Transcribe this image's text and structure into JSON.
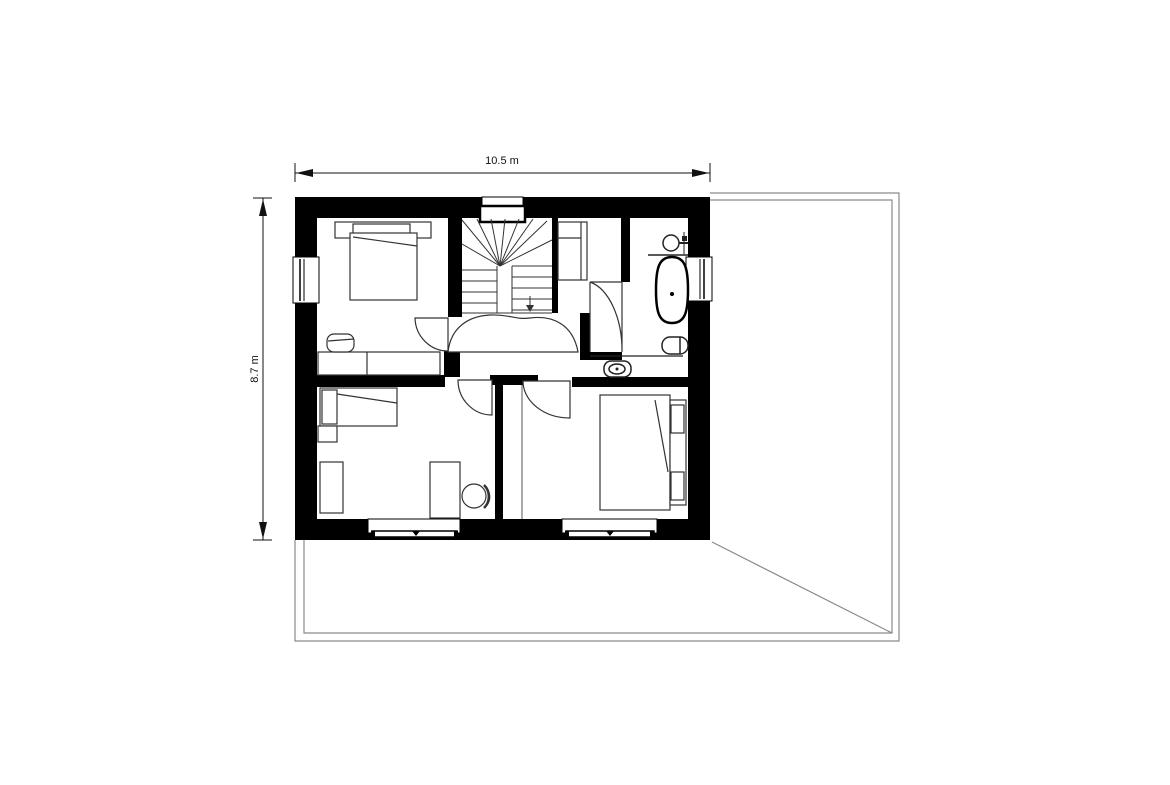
{
  "drawing": {
    "type": "architectural-floor-plan",
    "floor": "upper floor with three bedrooms, bathroom and winder staircase",
    "background_color": "#ffffff",
    "wall_color": "#000000",
    "line_color": "#222222",
    "roof_outline_color": "#8a8a8a"
  },
  "dimensions": {
    "width_label": "10.5 m",
    "height_label": "8.7 m"
  },
  "elements": [
    "exterior-walls",
    "interior-walls",
    "roof-outline",
    "roof-hip-diagonal",
    "winder-staircase",
    "stair-direction-arrow",
    "chimney",
    "window-top",
    "window-left",
    "window-right",
    "window-bottom-left",
    "window-bottom-right",
    "double-bed-top-left",
    "bench-sofa",
    "wardrobe-closet",
    "bathroom-sink",
    "freestanding-bathtub",
    "toilet",
    "bidet",
    "single-bed",
    "nightstand",
    "wardrobe",
    "desk",
    "desk-chair",
    "double-bed-bottom-right",
    "door-swing-arcs",
    "hall-landing",
    "dimension-line-top",
    "dimension-line-left"
  ]
}
